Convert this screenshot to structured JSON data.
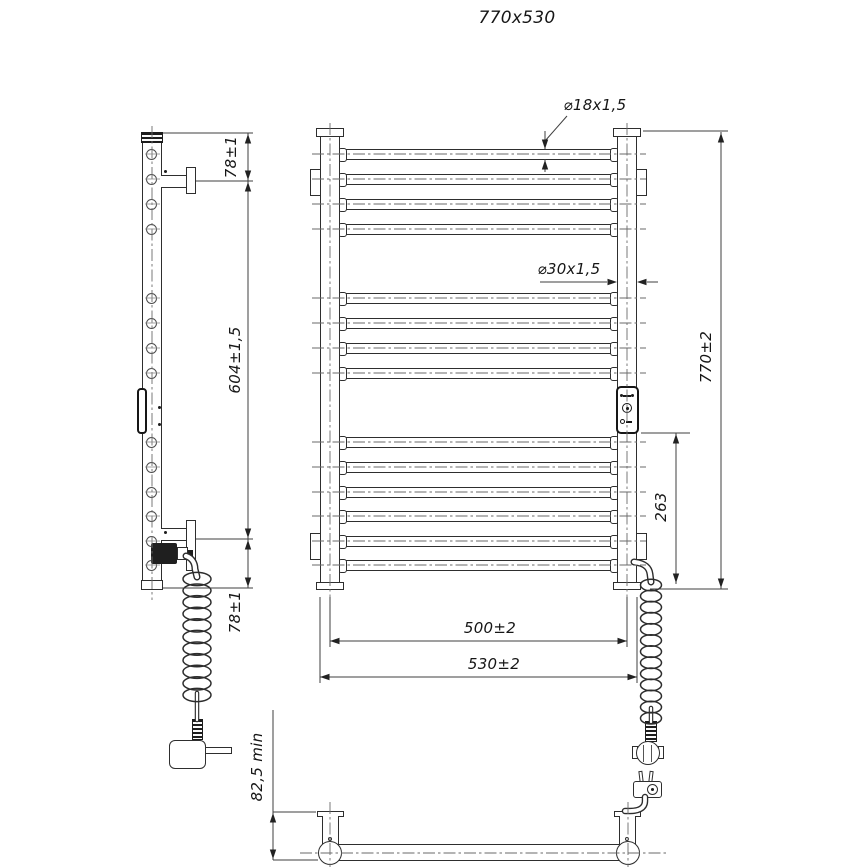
{
  "title": "770x530",
  "labels": {
    "rung_tube_dia": "⌀18x1,5",
    "vertical_tube_dia": "⌀30x1,5",
    "overall_height": "770±2",
    "control_box_offset": "263",
    "width_axis_to_axis": "500±2",
    "width_overall": "530±2",
    "bracket_top_offset": "78±1",
    "bracket_to_bracket": "604±1,5",
    "bracket_bottom_offset": "78±1",
    "wall_clearance": "82,5 min"
  },
  "structure": {
    "rung_count": 14,
    "rung_groups": [
      4,
      4,
      6
    ],
    "vertical_tubes": 2,
    "wall_brackets": 4
  },
  "line_color": "#2e2e2e"
}
